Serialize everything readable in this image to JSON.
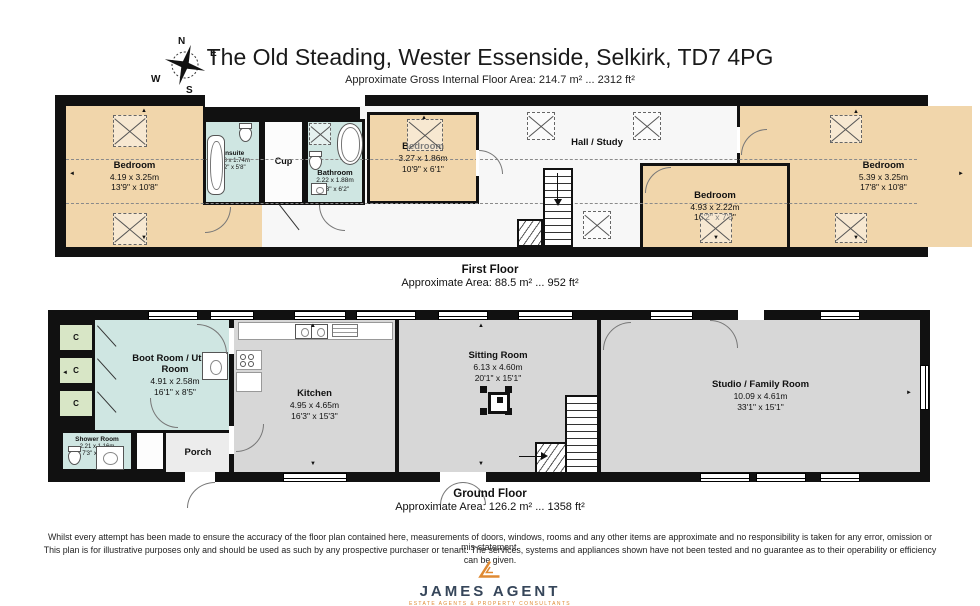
{
  "header": {
    "title": "The Old Steading, Wester Essenside, Selkirk, TD7 4PG",
    "subtitle": "Approximate Gross Internal Floor Area: 214.7 m² ... 2312 ft²"
  },
  "compass": {
    "n": "N",
    "e": "E",
    "s": "S",
    "w": "W"
  },
  "first_floor": {
    "label": "First Floor",
    "area": "Approximate Area: 88.5 m² ... 952 ft²",
    "rooms": {
      "bedroom1": {
        "name": "Bedroom",
        "metric": "4.19 x 3.25m",
        "imperial": "13'9\" x 10'8\""
      },
      "ensuite": {
        "name": "Ensuite",
        "metric": "1.88 x 1.74m",
        "imperial": "6'2\" x 5'8\""
      },
      "cup": {
        "name": "Cup"
      },
      "bathroom": {
        "name": "Bathroom",
        "metric": "2.22 x 1.88m",
        "imperial": "7'3\" x 6'2\""
      },
      "bedroom2": {
        "name": "Bedroom",
        "metric": "3.27 x 1.86m",
        "imperial": "10'9\" x 6'1\""
      },
      "hall": {
        "name": "Hall / Study"
      },
      "bedroom3": {
        "name": "Bedroom",
        "metric": "4.93 x 2.22m",
        "imperial": "16'2\" x 7'3\""
      },
      "bedroom4": {
        "name": "Bedroom",
        "metric": "5.39 x 3.25m",
        "imperial": "17'8\" x 10'8\""
      }
    }
  },
  "ground_floor": {
    "label": "Ground Floor",
    "area": "Approximate Area: 126.2 m² ... 1358 ft²",
    "rooms": {
      "cupboard": {
        "label": "C"
      },
      "boot_room": {
        "name": "Boot Room / Utility Room",
        "metric": "4.91 x 2.58m",
        "imperial": "16'1\" x 8'5\""
      },
      "shower": {
        "name": "Shower Room",
        "metric": "2.21 x 1.16m",
        "imperial": "7'3\" x 3'10\""
      },
      "porch": {
        "name": "Porch"
      },
      "kitchen": {
        "name": "Kitchen",
        "metric": "4.95 x 4.65m",
        "imperial": "16'3\" x 15'3\""
      },
      "sitting": {
        "name": "Sitting Room",
        "metric": "6.13 x 4.60m",
        "imperial": "20'1\" x 15'1\""
      },
      "studio": {
        "name": "Studio / Family Room",
        "metric": "10.09 x 4.61m",
        "imperial": "33'1\" x 15'1\""
      }
    }
  },
  "footer": {
    "disclaimer_line1": "Whilst every attempt has been made to ensure the accuracy of the floor plan contained here, measurements of doors, windows, rooms and any other items are approximate and no responsibility is taken for any error, omission or mis-statement.",
    "disclaimer_line2": "This plan is for illustrative purposes only and should be used as such by any prospective purchaser or tenant. The services, systems and appliances shown have not been tested and no guarantee as to their operability or efficiency can be given.",
    "brand": "JAMES AGENT",
    "tagline": "ESTATE AGENTS & PROPERTY CONSULTANTS"
  }
}
